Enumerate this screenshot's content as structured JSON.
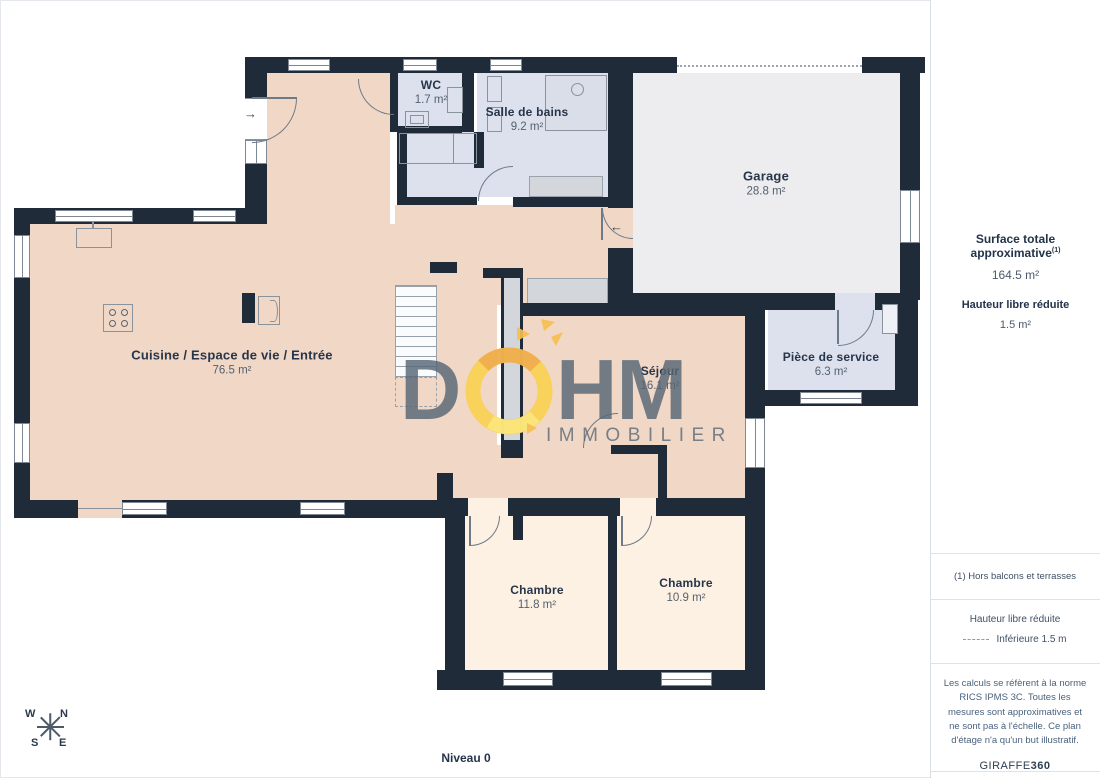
{
  "plan": {
    "level_label": "Niveau 0",
    "rooms": [
      {
        "name": "WC",
        "area": "1.7 m²"
      },
      {
        "name": "Salle de bains",
        "area": "9.2 m²"
      },
      {
        "name": "Garage",
        "area": "28.8 m²"
      },
      {
        "name": "Cuisine / Espace de vie / Entrée",
        "area": "76.5 m²"
      },
      {
        "name": "Séjour",
        "area": "16.1 m²"
      },
      {
        "name": "Pièce de service",
        "area": "6.3 m²"
      },
      {
        "name": "Chambre",
        "area": "11.8 m²"
      },
      {
        "name": "Chambre",
        "area": "10.9 m²"
      }
    ],
    "entry_arrow_in": "→",
    "garage_arrow_in": "←"
  },
  "compass": {
    "w": "W",
    "n": "N",
    "s": "S",
    "e": "E"
  },
  "watermark": {
    "d": "D",
    "hm": "HM",
    "subtitle": "IMMOBILIER"
  },
  "sidebar": {
    "surface_label": "Surface totale approximative",
    "surface_sup": "(1)",
    "surface_value": "164.5 m²",
    "hauteur_label": "Hauteur libre réduite",
    "hauteur_value": "1.5 m²",
    "footnote": "(1) Hors balcons et terrasses",
    "legend_title": "Hauteur libre réduite",
    "legend_value": "Inférieure 1.5 m",
    "disclaimer": "Les calculs se réfèrent à la norme RICS IPMS 3C. Toutes les mesures sont approximatives et ne sont pas à l'échelle. Ce plan d'étage n'a qu'un but illustratif.",
    "brand_name": "GIRAFFE",
    "brand_number": "360"
  },
  "colors": {
    "wall": "#202b3a",
    "floor_main": "#f1d7c6",
    "floor_bedroom": "#fdf1e3",
    "floor_wet": "#dce1ed",
    "floor_garage": "#ededef",
    "watermark_yellow": "#f9d150",
    "watermark_gray": "#566675"
  }
}
